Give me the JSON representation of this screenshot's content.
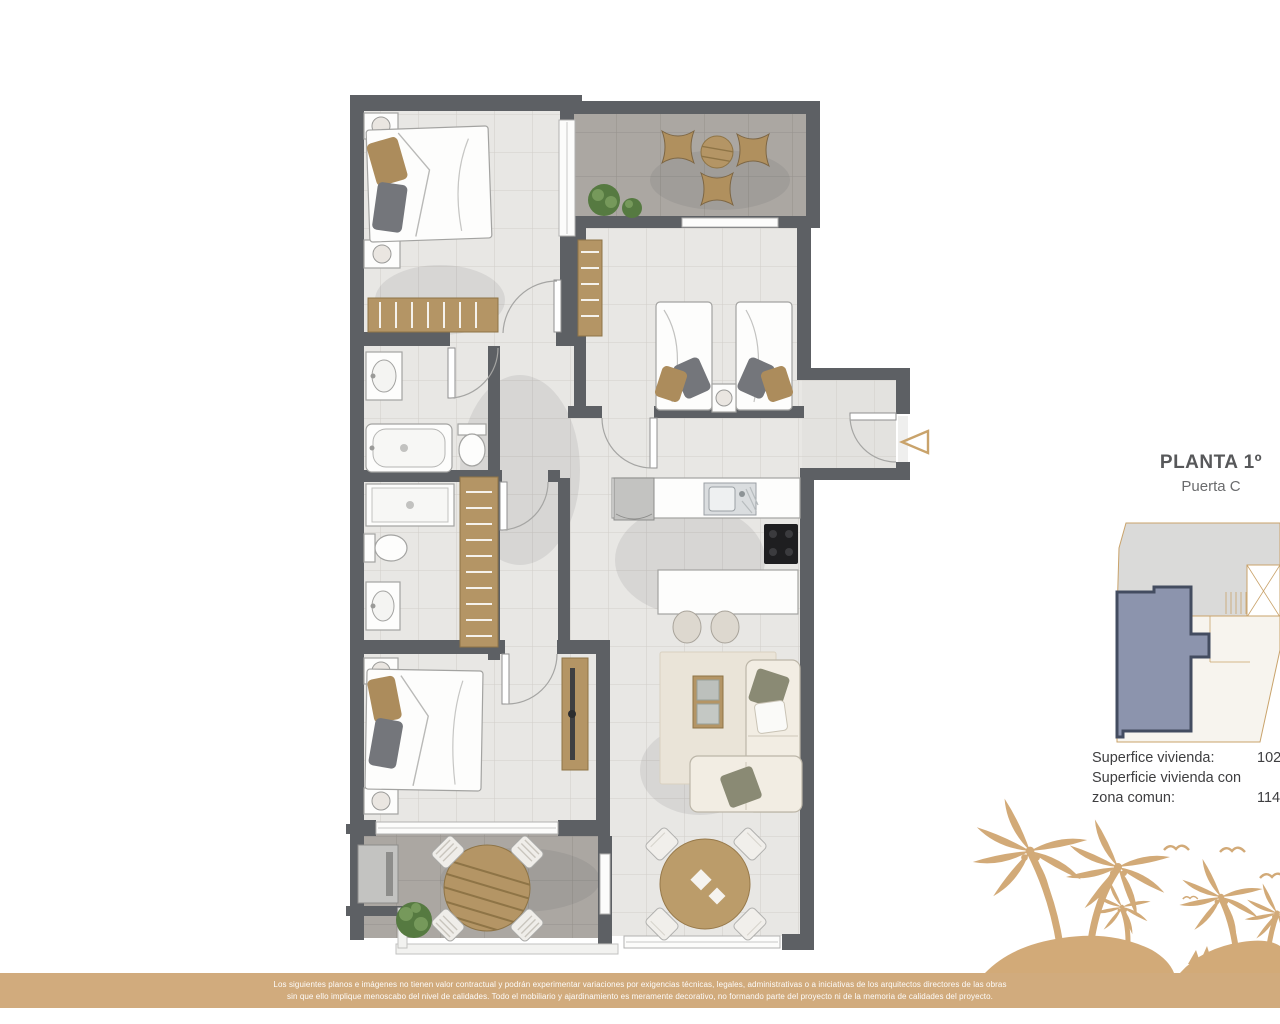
{
  "plan_label": {
    "title": "PLANTA 1º",
    "subtitle": "Puerta C"
  },
  "surface_info": {
    "line1_label": "Superfice vivienda:",
    "line1_value": "102.",
    "line2_label": "Superficie vivienda con",
    "line3_label": "zona comun:",
    "line3_value": "114."
  },
  "disclaimer": {
    "line1": "Los siguientes planos e imágenes no tienen valor contractual y podrán experimentar variaciones por exigencias técnicas, legales, administrativas o a iniciativas de los arquitectos directores de las obras",
    "line2": "sin que ello implique menoscabo del nivel de calidades. Todo el mobiliario y ajardinamiento es meramente decorativo, no formando parte del proyecto ni de la memoria de calidades del proyecto."
  },
  "icons": {
    "entrance_arrow": "left-triangle-outline",
    "decoration": "palm-beach-silhouette-with-birds"
  },
  "colors": {
    "accent_tan": "#C9A36B",
    "palm_tan": "#D2AA78",
    "bar_tan": "#D1AB7D",
    "wall_gray": "#5D6064",
    "unit_highlight": "#8C94AD",
    "unit_border": "#434C60",
    "wood": "#B49565",
    "title_gray": "#57585A"
  }
}
